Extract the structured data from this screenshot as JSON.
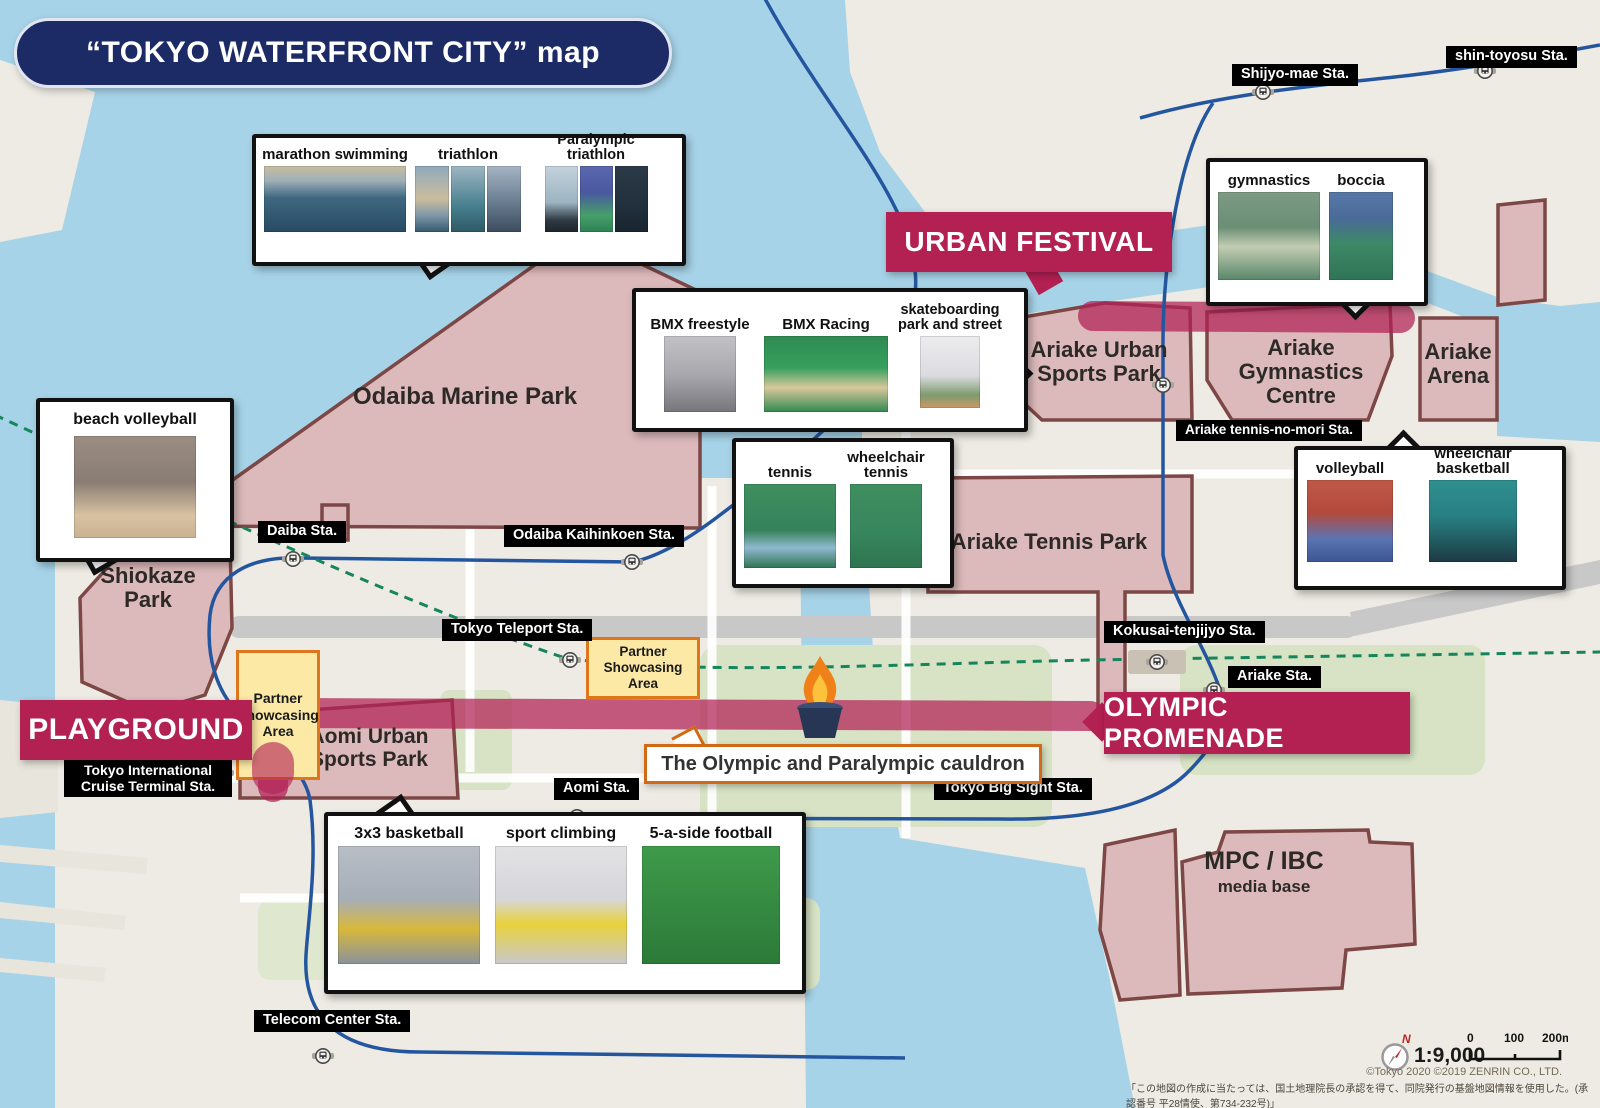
{
  "title": "“TOKYO WATERFRONT CITY”  map",
  "banners": {
    "urban_festival": "URBAN FESTIVAL",
    "playground": "PLAYGROUND",
    "olympic_promenade": "OLYMPIC PROMENADE"
  },
  "venues": [
    {
      "name": "Odaiba Marine Park"
    },
    {
      "name": "Shiokaze Park"
    },
    {
      "name": "Ariake Urban Sports Park"
    },
    {
      "name": "Ariake Gymnastics Centre"
    },
    {
      "name": "Ariake Arena"
    },
    {
      "name": "Ariake Tennis Park"
    },
    {
      "name": "Aomi Urban Sports Park"
    },
    {
      "name": "MPC / IBC",
      "subtitle": "media base"
    }
  ],
  "stations": [
    {
      "name": "Shijyo-mae Sta."
    },
    {
      "name": "shin-toyosu Sta."
    },
    {
      "name": "Daiba Sta."
    },
    {
      "name": "Odaiba Kaihinkoen Sta."
    },
    {
      "name": "Tokyo Teleport Sta."
    },
    {
      "name": "Kokusai-tenjijyo Sta."
    },
    {
      "name": "Ariake Sta."
    },
    {
      "name": "Ariake tennis-no-mori Sta."
    },
    {
      "name": "Tokyo International Cruise Terminal Sta."
    },
    {
      "name": "Aomi Sta."
    },
    {
      "name": "Tokyo Big Sight Sta."
    },
    {
      "name": "Telecom Center Sta."
    }
  ],
  "callouts": [
    {
      "sports": [
        "marathon swimming",
        "triathlon",
        "Paralympic triathlon"
      ]
    },
    {
      "sports": [
        "gymnastics",
        "boccia"
      ]
    },
    {
      "sports": [
        "BMX freestyle",
        "BMX Racing",
        "skateboarding park and street"
      ]
    },
    {
      "sports": [
        "beach volleyball"
      ]
    },
    {
      "sports": [
        "tennis",
        "wheelchair tennis"
      ]
    },
    {
      "sports": [
        "volleyball",
        "wheelchair basketball"
      ]
    },
    {
      "sports": [
        "3x3 basketball",
        "sport climbing",
        "5-a-side football"
      ]
    }
  ],
  "partner_area": {
    "label": "Partner Showcasing Area"
  },
  "cauldron": {
    "label": "The Olympic and Paralympic cauldron",
    "icon": "flame-cauldron-icon"
  },
  "footer": {
    "compass": "N",
    "scale_ratio": "1:9,000",
    "scale_ticks": [
      "0",
      "100",
      "200m"
    ],
    "copyright": "©Tokyo 2020  ©2019 ZENRIN CO., LTD.",
    "license_jp": "「この地図の作成に当たっては、国土地理院長の承認を得て、同院発行の基盤地図情報を使用した。(承認番号 平28情使、第734-232号)」"
  },
  "colors": {
    "banner": "#b32052",
    "venue_fill": "#dcb9ba",
    "venue_border": "#7d4746",
    "water": "#a7d3e8",
    "rail": "#2456a0",
    "promenade": "#b12055",
    "partner_fill": "#fce9a6",
    "partner_border": "#e0761c",
    "station_bg": "#000000",
    "title_bg": "#1c2a66"
  }
}
